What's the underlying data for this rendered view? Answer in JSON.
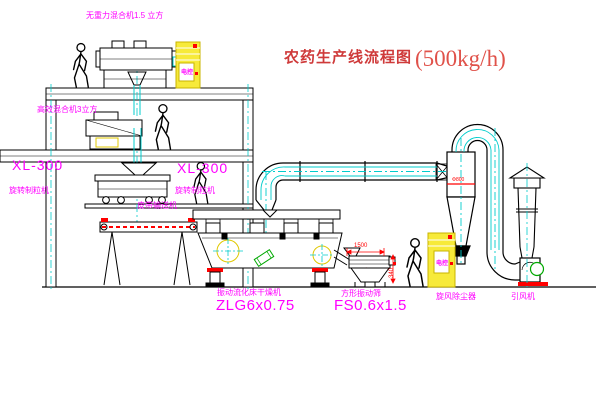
{
  "title": {
    "name": "农药生产线流程图",
    "capacity": "(500kg/h)"
  },
  "equipment": {
    "gravity_mixer": {
      "label": "无重力混合机1.5 立方"
    },
    "high_mixer": {
      "label": "高效混合机3立方"
    },
    "granulator_left": {
      "model": "XL-300",
      "label": "旋转制粒机"
    },
    "granulator_mid": {
      "model": "XL-300",
      "label": "旋转制粒机"
    },
    "belt_conveyor": {
      "label": "皮带输送机"
    },
    "fluid_bed_dryer": {
      "label": "振动流化床干燥机",
      "model": "ZLG6x0.75"
    },
    "square_sieve": {
      "label": "方形振动筛",
      "model": "FS0.6x1.5"
    },
    "cyclone": {
      "label": "旋风除尘器",
      "dim": "Φ800"
    },
    "fan": {
      "label": "引风机"
    },
    "cabinet_top": {
      "label": "电控"
    },
    "cabinet_right": {
      "label": "电控"
    }
  },
  "dimensions": {
    "sieve_length": "1500",
    "sieve_height": "340"
  },
  "colors": {
    "label_magenta": "#ff00ff",
    "title_red": "#cf3a3a",
    "dimension_red": "#ff0000",
    "centerline_cyan": "#00cccc",
    "cabinet_yellow": "#f2dc00",
    "motor_green": "#00a800",
    "line_black": "#000000"
  }
}
